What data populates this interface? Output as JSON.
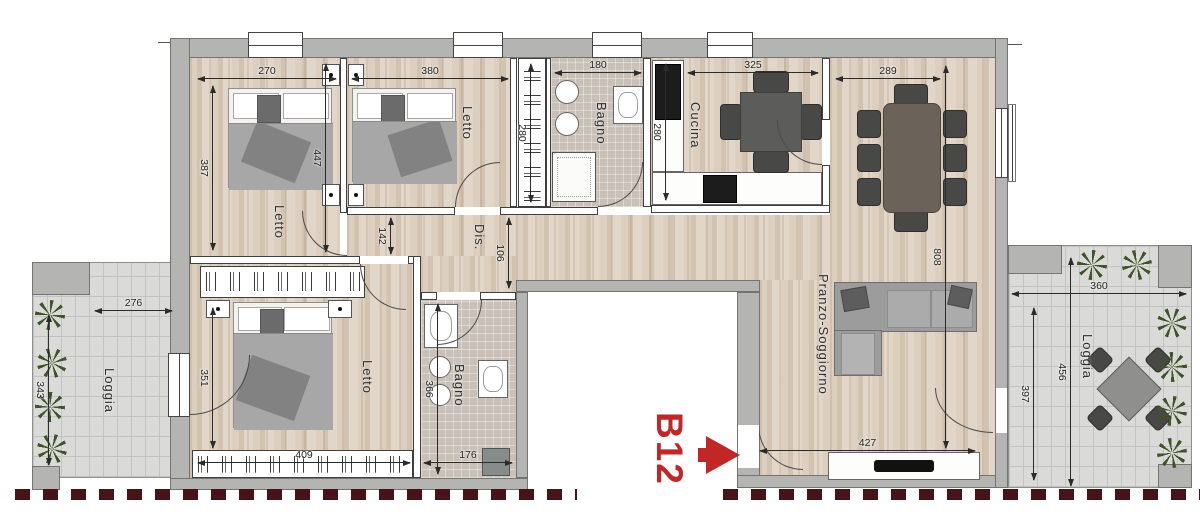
{
  "unit": {
    "label": "B12"
  },
  "rooms": {
    "bedroom_top_left": {
      "label": "Letto",
      "width_cm": "270",
      "height_cm": "387"
    },
    "bedroom_top_mid": {
      "label": "Letto",
      "width_cm": "380",
      "height_cm": "447"
    },
    "closet": {
      "height_cm": "280"
    },
    "bathroom_top": {
      "label": "Bagno",
      "width_cm": "180"
    },
    "kitchen": {
      "label": "Cucina",
      "width_cm": "325",
      "height_cm": "280"
    },
    "hallway": {
      "label": "Dis.",
      "width_left_cm": "142",
      "width_right_cm": "106"
    },
    "living": {
      "label": "Pranzo-Soggiorno",
      "top_width_cm": "289",
      "height_cm": "808",
      "bottom_width_cm": "427"
    },
    "bedroom_bottom": {
      "label": "Letto",
      "width_cm": "409",
      "height_cm": "351"
    },
    "bathroom_bottom": {
      "label": "Bagno",
      "width_cm": "176",
      "height_cm": "366"
    },
    "loggia_left": {
      "label": "Loggia",
      "width_cm": "276",
      "height_cm": "343"
    },
    "loggia_right": {
      "label": "Loggia",
      "width_cm": "360",
      "inner_height_cm": "397",
      "outer_height_cm": "456"
    }
  },
  "colors": {
    "unit_accent": "#c22727",
    "boundary_dash": "#451418",
    "wall_gray": "#b4b4b2"
  }
}
